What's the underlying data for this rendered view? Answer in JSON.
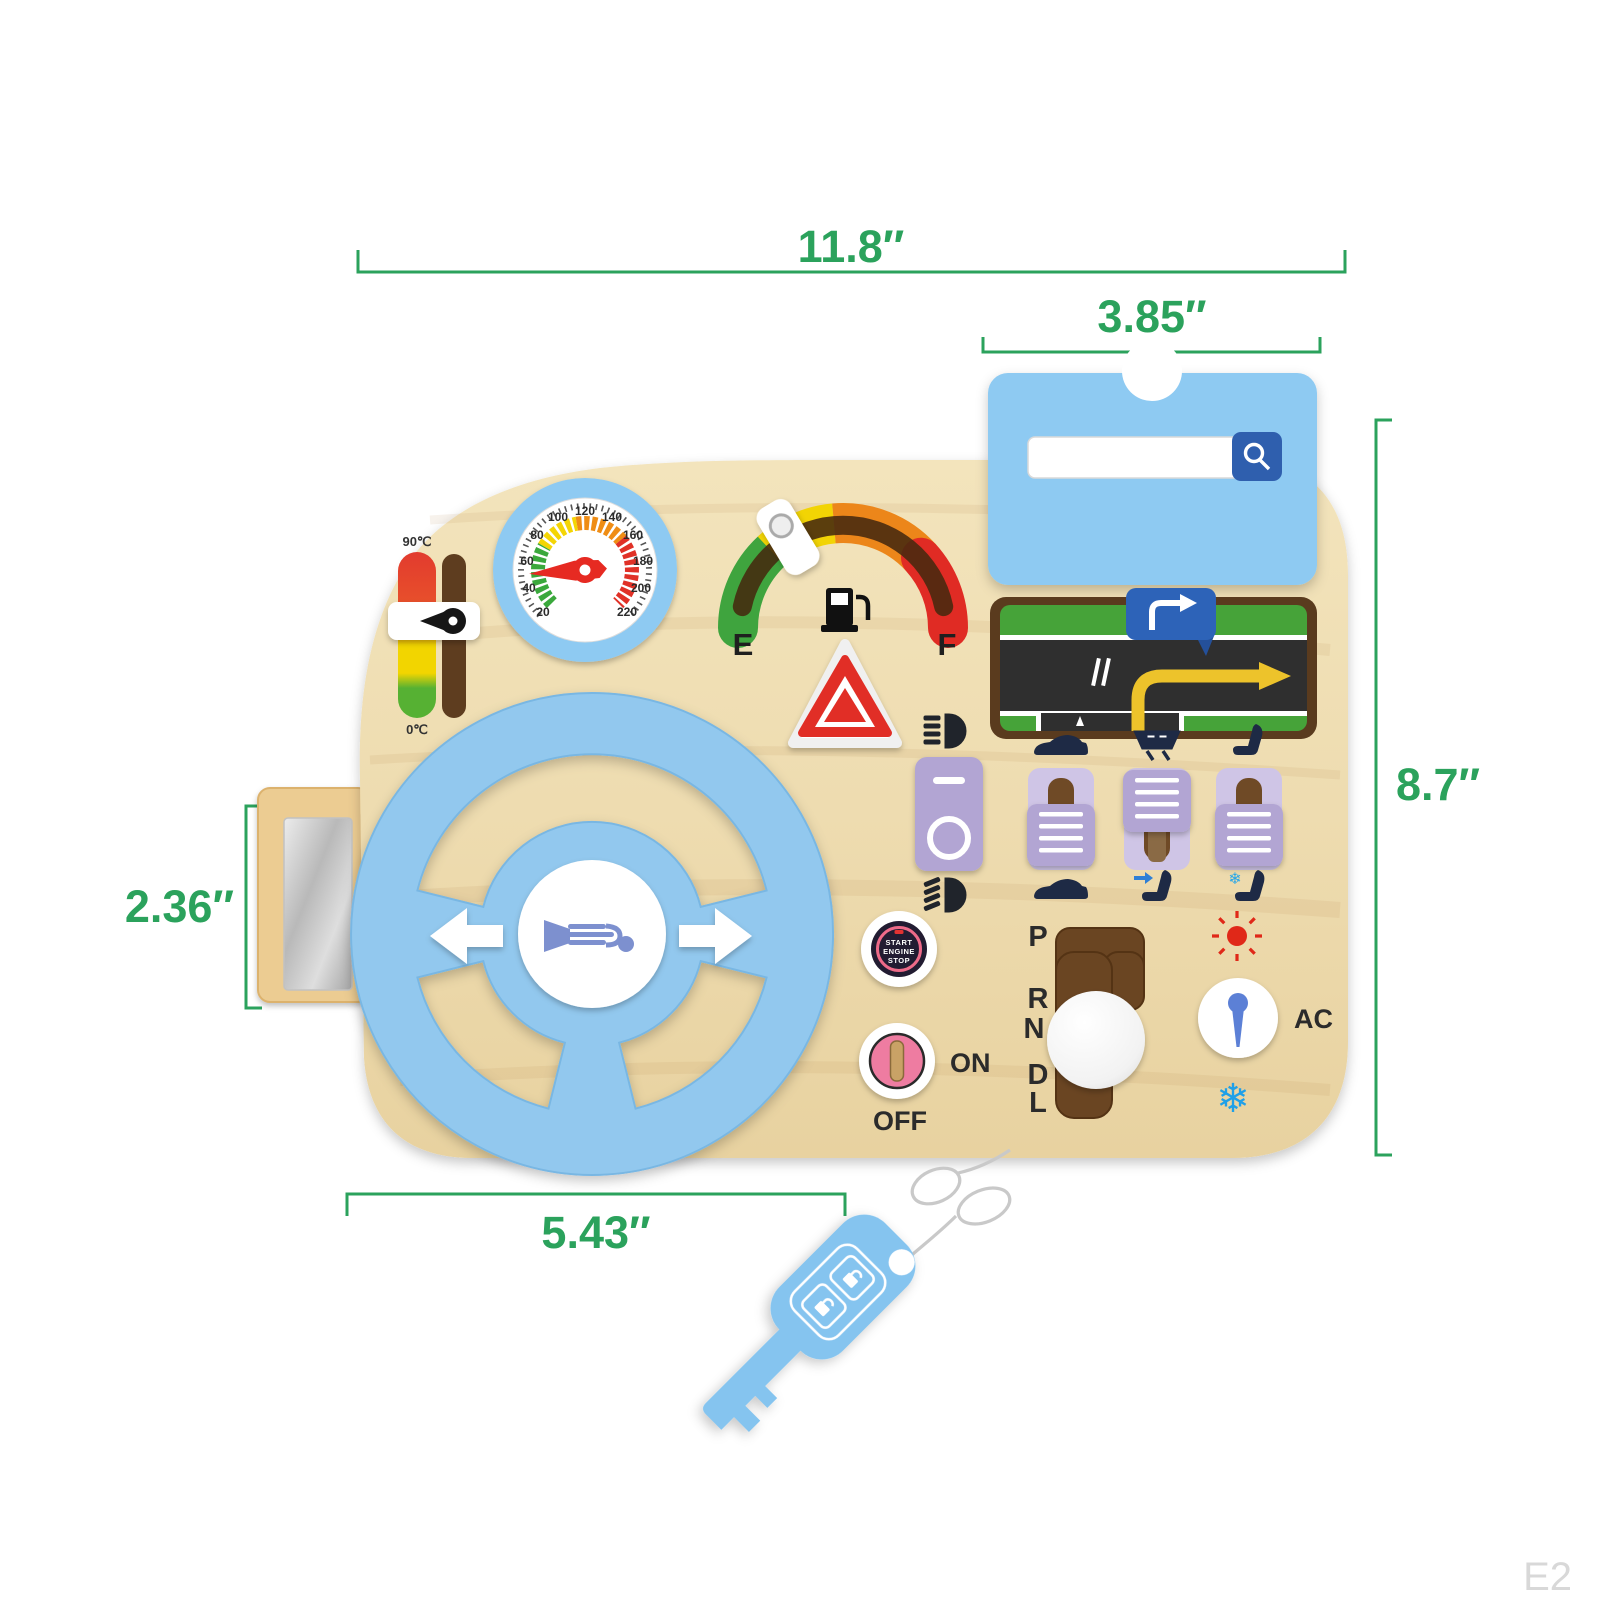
{
  "watermark": "E2",
  "accent_color": "#2ba25c",
  "board_color": "#eedcb0",
  "toy_blue": "#8ecaf2",
  "dimensions": {
    "board_width": "11.8″",
    "panel_width": "3.85″",
    "board_height": "8.7″",
    "mirror_height": "2.36″",
    "wheel_width": "5.43″"
  },
  "temperature_gauge": {
    "max_label": "90℃",
    "min_label": "0℃"
  },
  "speedometer": {
    "ticks": [
      "20",
      "40",
      "60",
      "80",
      "100",
      "120",
      "140",
      "160",
      "180",
      "200",
      "220"
    ]
  },
  "fuel_gauge": {
    "empty": "E",
    "full": "F"
  },
  "start_button": {
    "line1": "START",
    "line2": "ENGINE",
    "line3": "STOP"
  },
  "ignition": {
    "on": "ON",
    "off": "OFF"
  },
  "shifter": {
    "gears": [
      "P",
      "R",
      "N",
      "D",
      "L"
    ]
  },
  "climate": {
    "label": "AC",
    "snowflake_glyph": "❄"
  },
  "icons": {
    "search": "magnifier-icon",
    "fuel_pump": "fuel-pump-icon",
    "hazard": "warning-triangle-icon",
    "high_beam": "high-beam-icon",
    "low_beam": "low-beam-icon",
    "car": "car-icon",
    "wiper": "wiper-icon",
    "seat": "seat-icon",
    "heated_seat": "seat-arrow-icon",
    "cooled_seat": "seat-snowflake-icon",
    "sun": "sun-icon",
    "snowflake_glyph": "❄",
    "horn": "horn-icon",
    "turn_right": "turn-right-arrow-icon",
    "key": "car-key-icon"
  }
}
